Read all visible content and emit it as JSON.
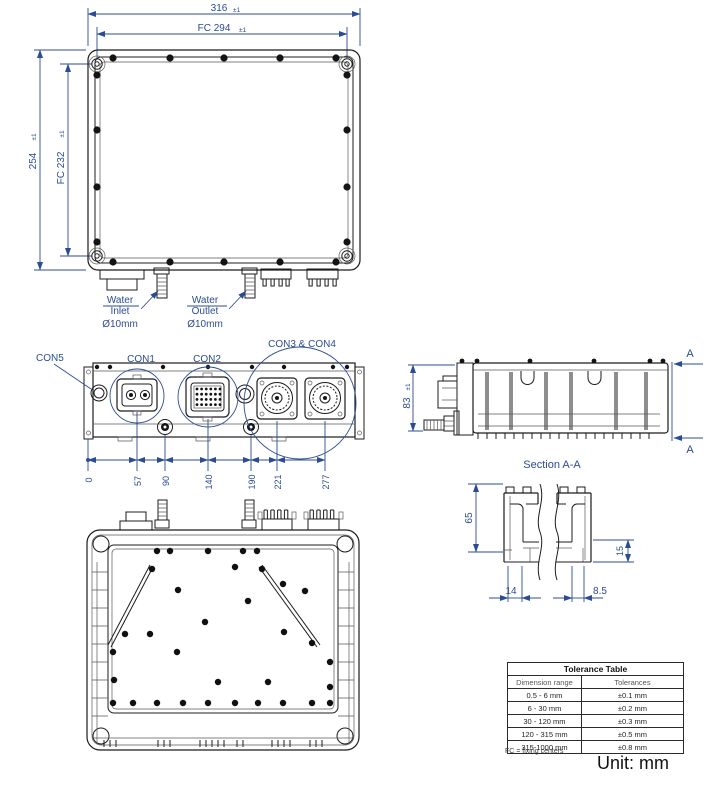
{
  "notes": {
    "unit": "Unit: mm",
    "fc": "FC = fixing centers"
  },
  "top_view": {
    "overall_width": {
      "value": "316",
      "tol": "±1"
    },
    "fixing_centers_width": {
      "value": "FC 294",
      "tol": "±1"
    },
    "overall_height": {
      "value": "254",
      "tol": "±1"
    },
    "fixing_centers_height": {
      "value": "FC 232",
      "tol": "±1"
    },
    "water_inlet": {
      "line1": "Water",
      "line2": "Inlet",
      "diameter": "Ø10mm"
    },
    "water_outlet": {
      "line1": "Water",
      "line2": "Outlet",
      "diameter": "Ø10mm"
    }
  },
  "front_view": {
    "labels": {
      "con5": "CON5",
      "con1": "CON1",
      "con2": "CON2",
      "con3_con4": "CON3 & CON4"
    },
    "positions": [
      "0",
      "57",
      "90",
      "140",
      "190",
      "221",
      "277"
    ]
  },
  "side_view": {
    "height": {
      "value": "83",
      "tol": "±1"
    },
    "section_marker_top": "A",
    "section_marker_bottom": "A"
  },
  "section_view": {
    "title": "Section A-A",
    "overall_height": "65",
    "foot_height": "15",
    "channel_width": "14",
    "wall_offset": "8.5"
  },
  "tolerance_table": {
    "title": "Tolerance Table",
    "headers": [
      "Dimension range",
      "Tolerances"
    ],
    "rows": [
      [
        "0.5 - 6 mm",
        "±0.1 mm"
      ],
      [
        "6 - 30 mm",
        "±0.2 mm"
      ],
      [
        "30 - 120 mm",
        "±0.3 mm"
      ],
      [
        "120 - 315 mm",
        "±0.5 mm"
      ],
      [
        "315-1000 mm",
        "±0.8 mm"
      ]
    ]
  },
  "colors": {
    "dimension_accent": "#2b4c94",
    "line": "#1c1c1c"
  }
}
